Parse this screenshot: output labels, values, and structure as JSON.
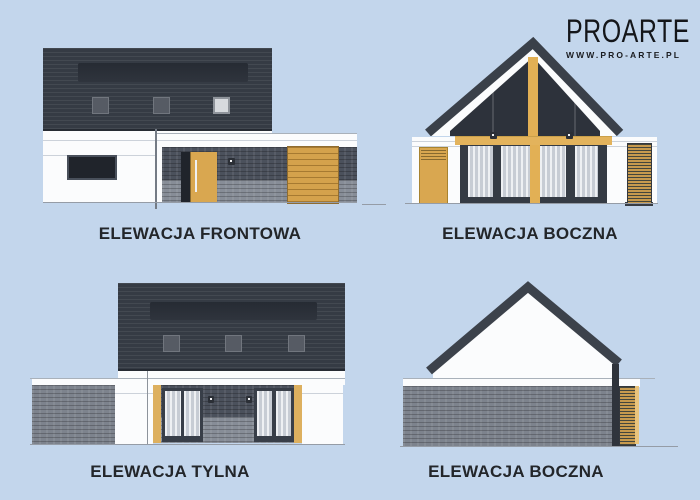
{
  "logo": {
    "brand": "PROARTE",
    "url": "WWW.PRO-ARTE.PL"
  },
  "elevations": {
    "front": {
      "label": "ELEWACJA FRONTOWA"
    },
    "side_top": {
      "label": "ELEWACJA BOCZNA"
    },
    "rear": {
      "label": "ELEWACJA TYLNA"
    },
    "side_bottom": {
      "label": "ELEWACJA BOCZNA"
    }
  },
  "colors": {
    "background": "#c3d6ec",
    "roof_dark": "#353b44",
    "roof_skylight_band": "#2a2f38",
    "wall_white": "#fbfcfd",
    "brick_dark": "#4b515c",
    "brick_light": "#878d97",
    "brick_mid": "#7d838d",
    "wood_door": "#d9a750",
    "wood_beam": "#e3b35c",
    "glass_dark": "#20242b",
    "curtain_light": "#eef0f3",
    "curtain_shade": "#c7ccd4",
    "label_text": "#23262a",
    "ground_line": "#959ca6"
  }
}
